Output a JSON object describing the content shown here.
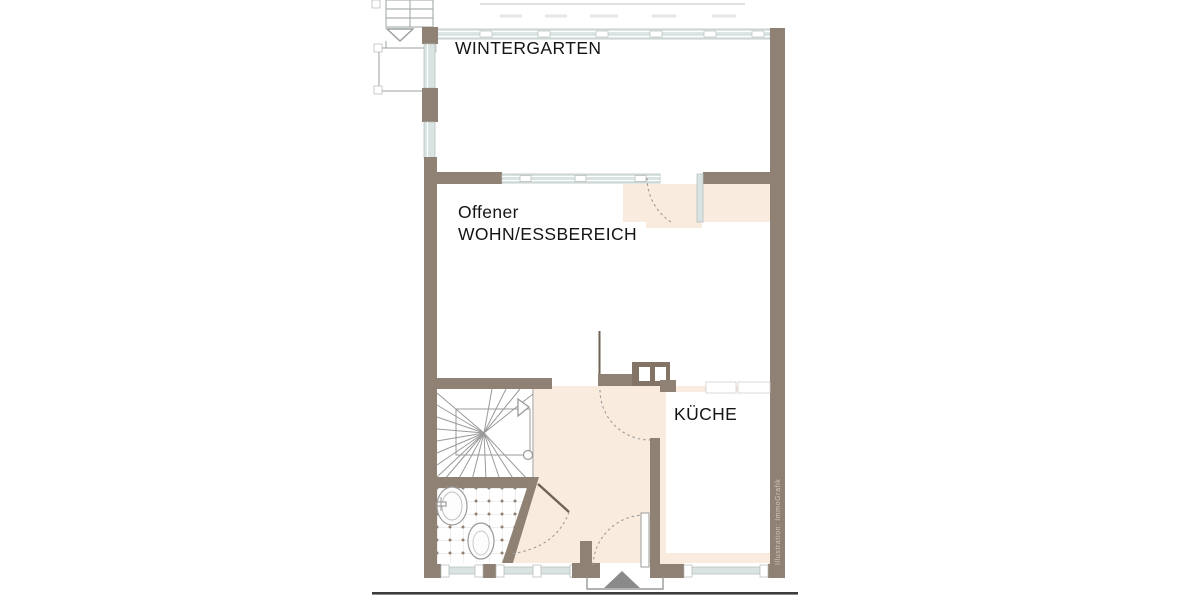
{
  "plan": {
    "rooms": {
      "wintergarten": {
        "label": "WINTERGARTEN"
      },
      "living": {
        "label_line1": "Offener",
        "label_line2": "WOHN/ESSBEREICH"
      },
      "kitchen": {
        "label": "KÜCHE"
      }
    },
    "watermark": "Illustration: ImmoGrafik"
  },
  "colors": {
    "wall": "#8f8173",
    "wall-dark": "#837466",
    "glass": "#d9e4e2",
    "glass-frame": "#ffffff",
    "floor-cream": "#f9ecdf",
    "tile-dot": "#8f8173",
    "line-gray": "#9a9a9a",
    "door-line": "#6f6355",
    "arc-gray": "#9a9a9a",
    "arrow-gray": "#8a8a8a",
    "ground": "#3c3c3c",
    "roof-line": "#d2d7d5",
    "porch-line": "#aab0ae",
    "label-text": "#141414",
    "watermark": "#d3ccc0"
  }
}
